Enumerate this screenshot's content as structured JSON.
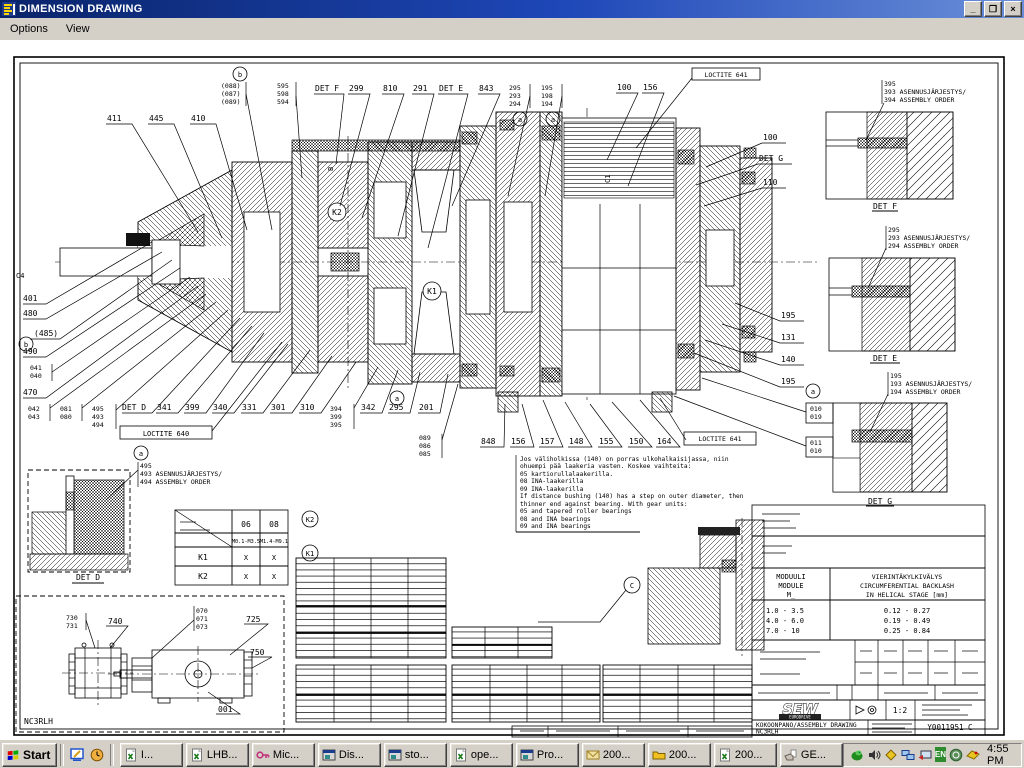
{
  "window": {
    "title": "DIMENSION DRAWING",
    "controls": {
      "minimize": "_",
      "restore": "❐",
      "close": "×"
    }
  },
  "menu": {
    "options": "Options",
    "view": "View"
  },
  "drawing": {
    "callouts": {
      "top_left": [
        "411",
        "445",
        "410"
      ],
      "b_stack": [
        "(088)",
        "(087)",
        "(089)"
      ],
      "f_stack": [
        "595",
        "598",
        "594"
      ],
      "det_f_ref": "DET F",
      "top_mid": [
        "299",
        "810",
        "291",
        "DET E",
        "843"
      ],
      "a1_stack": [
        "295",
        "293",
        "294"
      ],
      "a2_stack": [
        "195",
        "198",
        "194"
      ],
      "top_right": [
        "100",
        "156"
      ],
      "loctite_top": "LOCTITE 641",
      "right_upper": [
        "100",
        "DET G",
        "110"
      ],
      "right_side": [
        "195",
        "131",
        "140",
        "195"
      ],
      "right_box1": [
        "010",
        "019"
      ],
      "right_box2": [
        "011",
        "010"
      ],
      "left_side": [
        "401",
        "480",
        "(485)",
        "490"
      ],
      "left_pair": [
        "041",
        "040"
      ],
      "left_470": "470",
      "bl_pair1": [
        "042",
        "043"
      ],
      "bl_pair2": [
        "081",
        "080"
      ],
      "bl_stack": [
        "495",
        "493",
        "494"
      ],
      "det_d_ref": "DET D",
      "bottom_row": [
        "341",
        "399",
        "340",
        "331",
        "301",
        "310"
      ],
      "bottom_stack": [
        "394",
        "399",
        "395"
      ],
      "bottom_after": [
        "342",
        "295",
        "201"
      ],
      "loctite_left": "LOCTITE 640",
      "mid_stack": [
        "089",
        "086",
        "085"
      ],
      "bottom_mid": [
        "848",
        "156",
        "157",
        "148",
        "155",
        "150",
        "164"
      ],
      "loctite_bottom": "LOCTITE 641",
      "circle_a": "a",
      "circle_b": "b",
      "circle_c": "C",
      "k1": "K1",
      "k2": "K2",
      "c4": "C4",
      "c1": "C1",
      "b_sec": "B"
    },
    "details": {
      "det_f": {
        "title": "DET F",
        "stack": [
          "395",
          "393 ASENNUSJÄRJESTYS/",
          "394 ASSEMBLY ORDER"
        ]
      },
      "det_e": {
        "title": "DET E",
        "stack": [
          "295",
          "293 ASENNUSJÄRJESTYS/",
          "294 ASSEMBLY ORDER"
        ]
      },
      "det_g": {
        "title": "DET G",
        "stack": [
          "195",
          "193 ASENNUSJÄRJESTYS/",
          "194 ASSEMBLY ORDER"
        ]
      },
      "det_d": {
        "title": "DET D",
        "stack": [
          "495",
          "493 ASENNUSJÄRJESTYS/",
          "494 ASSEMBLY ORDER"
        ]
      }
    },
    "notes": [
      "Jos väliholkissa (140) on porras ulkohalkaisijassa, niin",
      "ohuempi pää laakeria vasten. Koskee vaihteita:",
      "05 kartiorullalaakerilla.",
      "08 INA-laakerilla",
      "09 INA-laakerilla",
      "If distance bushing (140) has a step on outer diameter, then",
      "thinner end against bearing. With gear units:",
      "05 and tapered roller bearings",
      "08 and INA bearings",
      "09 and INA bearings"
    ],
    "k_table": {
      "cols": [
        "06",
        "08"
      ],
      "subcols": [
        "M0.1-M3.5",
        "M1.4-M9.1"
      ],
      "rows": [
        {
          "label": "K1",
          "cells": [
            "X",
            "X"
          ]
        },
        {
          "label": "K2",
          "cells": [
            "X",
            "X"
          ]
        }
      ]
    },
    "module_table": {
      "col1": [
        "MODUULI",
        "MODULE",
        "M_"
      ],
      "col2": [
        "VIERINTÄKYLKIVÄLYS",
        "CIRCUMFERENTIAL BACKLASH",
        "IN HELICAL STAGE [mm]"
      ],
      "rows": [
        [
          "1.0 - 3.5",
          "0.12 - 0.27"
        ],
        [
          "4.0 - 6.0",
          "0.19 - 0.49"
        ],
        [
          "7.0 - 10",
          "0.25 - 0.84"
        ]
      ]
    },
    "title_block": {
      "logo": "SEW",
      "logo_sub": "EURODRIVE",
      "scale": "1:2",
      "doc_line1": "KOKOONPANO/ASSEMBLY DRAWING",
      "doc_line2": "NC3RLH",
      "number": "Y0011951 C"
    },
    "overview": {
      "pair": [
        "730",
        "731"
      ],
      "l740": "740",
      "stack": [
        "070",
        "071",
        "073"
      ],
      "l725": "725",
      "l750": "750",
      "l001": "001",
      "code": "NC3RLH"
    }
  },
  "taskbar": {
    "start": "Start",
    "quick_launch": [
      "show-desktop-icon",
      "clock-icon"
    ],
    "tasks": [
      {
        "icon": "excel-icon",
        "label": "I..."
      },
      {
        "icon": "excel-icon",
        "label": "LHB..."
      },
      {
        "icon": "key-icon",
        "label": "Mic..."
      },
      {
        "icon": "window-icon",
        "label": "Dis..."
      },
      {
        "icon": "window-icon",
        "label": "sto..."
      },
      {
        "icon": "excel-icon",
        "label": "ope..."
      },
      {
        "icon": "window-icon",
        "label": "Pro..."
      },
      {
        "icon": "mail-icon",
        "label": "200..."
      },
      {
        "icon": "folder-icon",
        "label": "200..."
      },
      {
        "icon": "excel-icon",
        "label": "200..."
      },
      {
        "icon": "hand-icon",
        "label": "GE..."
      }
    ],
    "tray": {
      "icons": [
        "dragon-icon",
        "volume-icon",
        "diamond-icon",
        "network-icon",
        "remote-icon",
        "sync-icon",
        "mail-notify-icon"
      ],
      "lang": "EN",
      "time": "4:55 PM"
    }
  }
}
